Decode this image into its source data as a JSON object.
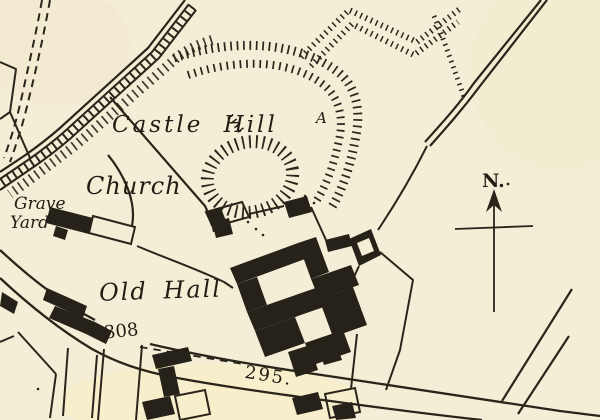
{
  "map": {
    "labels": {
      "castle_hill": "Castle Hill",
      "church": "Church",
      "grave": "Grave",
      "yard": "Yard",
      "old_hall": "Old Hall",
      "annotation_a": "A",
      "north": "N.",
      "spot_height_upper": "308",
      "spot_height_lower": "295."
    },
    "colors": {
      "paper": "#f5eed6",
      "ink": "#2a251b",
      "text": "#221d14"
    },
    "symbols": {
      "north_arrow": "north-arrow",
      "spot_dots": "spot-height-dot",
      "hachures": "earthwork-hachures"
    }
  }
}
